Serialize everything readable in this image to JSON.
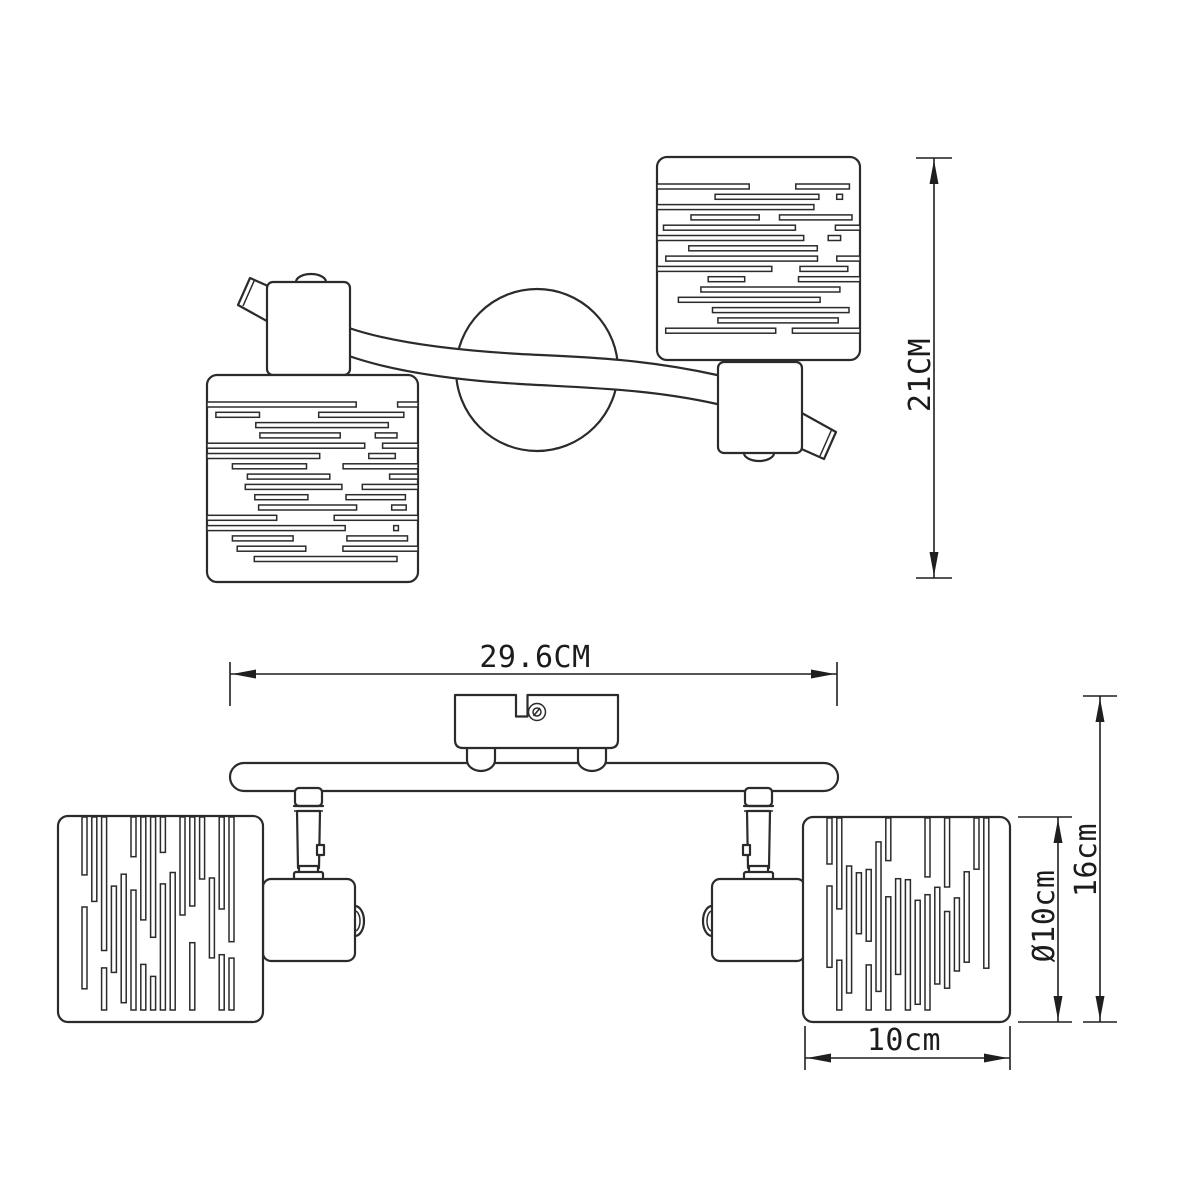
{
  "labels": {
    "top_view_height": "21CM",
    "front_view_width": "29.6CM",
    "front_view_total_height": "16cm",
    "shade_diameter": "Ø10cm",
    "shade_width": "10cm"
  },
  "style": {
    "background": "#ffffff",
    "line_color": "#2b2b2b",
    "dimension_color": "#1f1f1f"
  }
}
